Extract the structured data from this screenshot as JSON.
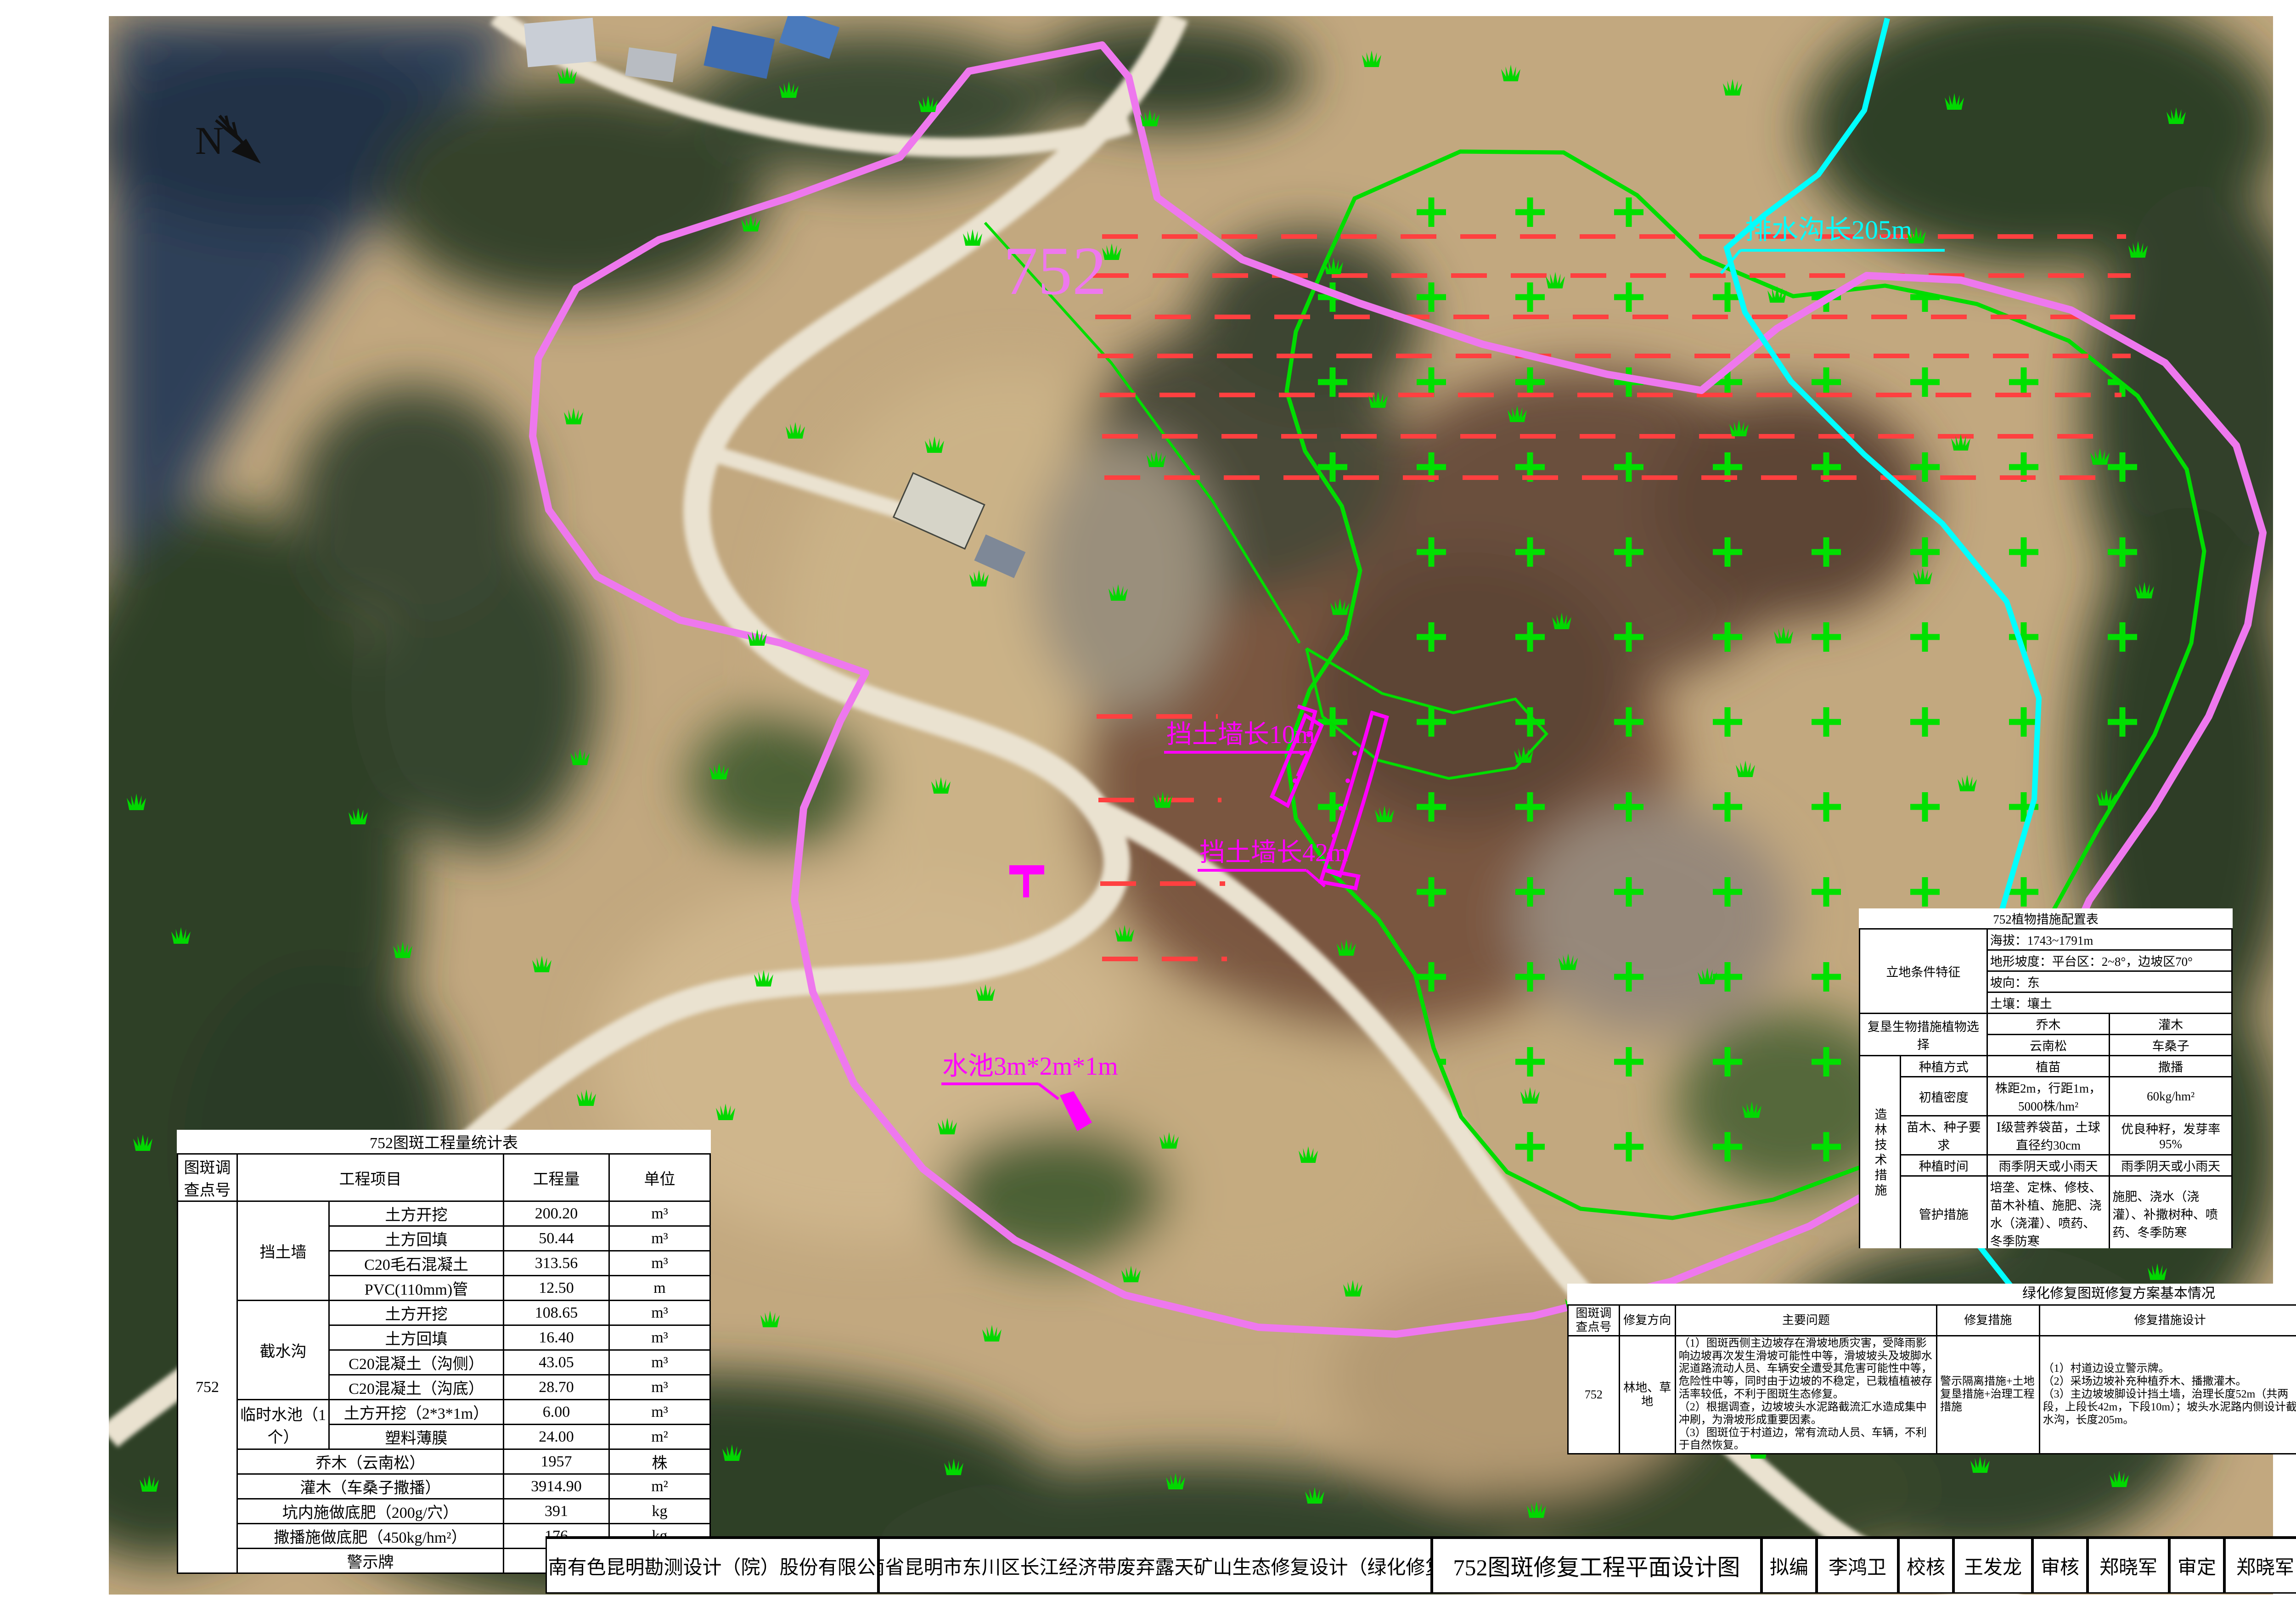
{
  "map": {
    "north_label": "N",
    "patch_label": "752",
    "labels": {
      "drain": "排水沟长205m",
      "wall_upper": "挡土墙长10m",
      "wall_lower": "挡土墙长42m",
      "pool": "水池3m*2m*1m"
    }
  },
  "legend": {
    "title": "图  例",
    "items": [
      {
        "name": "patch-number",
        "label": "图斑及调查点号（本次工作对象）",
        "sample": "752"
      },
      {
        "name": "warning-sign",
        "label": "拟设警示牌"
      },
      {
        "name": "retaining-wall",
        "label": "拟设挡土墙"
      },
      {
        "name": "temporary-pool",
        "label": "拟设临时水池"
      },
      {
        "name": "intercepting-ditch",
        "label": "拟设截水沟"
      },
      {
        "name": "steep-slope",
        "label": "高陡边坡区域"
      },
      {
        "name": "natural-recovery",
        "label": "已自然恢复区域"
      },
      {
        "name": "design-revegetation",
        "label": "设计植被修复区域"
      }
    ]
  },
  "planting_panel": {
    "title": "该图斑修复为乔灌木林地林草平面配置图",
    "subtitle": "（种植云南松、车桑子）",
    "sowing_note": "车桑子采取撒播(60.0kg/hm²)",
    "tree_label": "云南松",
    "row_spacing": "2m",
    "line_spacing": "1m"
  },
  "quantity_table": {
    "title": "752图斑工程量统计表",
    "headers": {
      "point": "图斑调查点号",
      "item": "工程项目",
      "qty": "工程量",
      "unit": "单位"
    },
    "point_id": "752",
    "rows": [
      {
        "group": "挡土墙",
        "span": 4,
        "item": "土方开挖",
        "qty": "200.20",
        "unit": "m³"
      },
      {
        "item": "土方回填",
        "qty": "50.44",
        "unit": "m³"
      },
      {
        "item": "C20毛石混凝土",
        "qty": "313.56",
        "unit": "m³"
      },
      {
        "item": "PVC(110mm)管",
        "qty": "12.50",
        "unit": "m"
      },
      {
        "group": "截水沟",
        "span": 4,
        "item": "土方开挖",
        "qty": "108.65",
        "unit": "m³"
      },
      {
        "item": "土方回填",
        "qty": "16.40",
        "unit": "m³"
      },
      {
        "item": "C20混凝土（沟侧）",
        "qty": "43.05",
        "unit": "m³"
      },
      {
        "item": "C20混凝土（沟底）",
        "qty": "28.70",
        "unit": "m³"
      },
      {
        "group": "临时水池（1个）",
        "span": 2,
        "item": "土方开挖（2*3*1m）",
        "qty": "6.00",
        "unit": "m³"
      },
      {
        "item": "塑料薄膜",
        "qty": "24.00",
        "unit": "m²"
      },
      {
        "wide": "乔木（云南松）",
        "qty": "1957",
        "unit": "株"
      },
      {
        "wide": "灌木（车桑子撒播）",
        "qty": "3914.90",
        "unit": "m²"
      },
      {
        "wide": "坑内施做底肥（200g/穴）",
        "qty": "391",
        "unit": "kg"
      },
      {
        "wide": "撒播施做底肥（450kg/hm²）",
        "qty": "176",
        "unit": "kg"
      },
      {
        "wide": "警示牌",
        "qty": "1",
        "unit": "个"
      }
    ]
  },
  "plant_table": {
    "title": "752植物措施配置表",
    "site_label": "立地条件特征",
    "site_rows": [
      "海拔：1743~1791m",
      "地形坡度：平台区：2~8°，边坡区70°",
      "坡向：东",
      "土壤：壤土"
    ],
    "selection_label": "复垦生物措施植物选择",
    "type_row": [
      "乔木",
      "灌木"
    ],
    "species_row": [
      "云南松",
      "车桑子"
    ],
    "tech_label": "造林技术措施",
    "tech_rows": [
      {
        "label": "种植方式",
        "tree": "植苗",
        "shrub": "撒播"
      },
      {
        "label": "初植密度",
        "tree": "株距2m，行距1m，5000株/hm²",
        "shrub": "60kg/hm²"
      },
      {
        "label": "苗木、种子要求",
        "tree": "Ⅰ级营养袋苗，土球直径约30cm",
        "shrub": "优良种籽，发芽率95%"
      },
      {
        "label": "种植时间",
        "tree": "雨季阴天或小雨天",
        "shrub": "雨季阴天或小雨天"
      },
      {
        "label": "管护措施",
        "tree": "培垄、定株、修枝、苗木补植、施肥、浇水（浇灌）、喷药、冬季防寒",
        "shrub": "施肥、浇水（浇灌）、补撒树种、喷药、冬季防寒"
      }
    ],
    "water_label": "水源条件",
    "water_text": "1）于752图斑北侧开挖临时水池，并用塑料膜覆盖，收集降雨汇水；\n（2）旱季是可用水车从播卡村耕地灌溉水渠内取水，里程约5.0km。"
  },
  "plan_table": {
    "title": "绿化修复图斑修复方案基本情况",
    "headers": [
      "图斑调查点号",
      "修复方向",
      "主要问题",
      "修复措施",
      "修复措施设计",
      "交通条件",
      "运输距离（km）",
      "临时交通工程量"
    ],
    "row": {
      "point_id": "752",
      "direction": "林地、草地",
      "problems": "（1）图斑西侧主边坡存在滑坡地质灾害，受降雨影响边坡再次发生滑坡可能性中等，滑坡坡头及坡脚水泥道路流动人员、车辆安全遭受其危害可能性中等，危险性中等，同时由于边坡的不稳定，已栽植植被存活率较低，不利于图斑生态修复。\n（2）根据调查，边坡坡头水泥路截流汇水造成集中冲刷，为滑坡形成重要因素。\n（3）图斑位于村道边，常有流动人员、车辆，不利于自然恢复。",
      "measures": "警示隔离措施+土地复垦措施+治理工程措施",
      "design": "（1）村道边设立警示牌。\n（2）采场边坡补充种植乔木、播撒灌木。\n（3）主边坡坡脚设计挡土墙，治理长度52m（共两段，上段长42m，下段10m）；坡头水泥路内侧设计截水沟，长度205m。",
      "traffic": "位于拖布卡镇播卡村红岩小组村道边，车辆可直接到达，交通便利。",
      "distance": "至东川城区：56.32km\n至拖布卡镇：13.68km",
      "temp_traffic": "/"
    }
  },
  "title_block": {
    "company": "西南有色昆明勘测设计（院）股份有限公司",
    "project": "云南省昆明市东川区长江经济带废弃露天矿山生态修复设计（绿化修复）",
    "drawing_title": "752图斑修复工程平面设计图",
    "fields": [
      {
        "label": "拟编",
        "value": "李鸿卫"
      },
      {
        "label": "校核",
        "value": "王发龙"
      },
      {
        "label": "审核",
        "value": "郑晓军"
      },
      {
        "label": "审定",
        "value": "郑晓军"
      },
      {
        "label": "图号",
        "value": "02"
      },
      {
        "label": "顺序号",
        "value": "02"
      },
      {
        "label": "日期",
        "value": "2020.04"
      }
    ]
  },
  "colors": {
    "boundary_violet": "#ee78ee",
    "overlay_magenta": "#ff00ff",
    "ditch_cyan": "#00ffff",
    "slope_red": "#ff4040",
    "vegetation_green": "#00dd00"
  }
}
